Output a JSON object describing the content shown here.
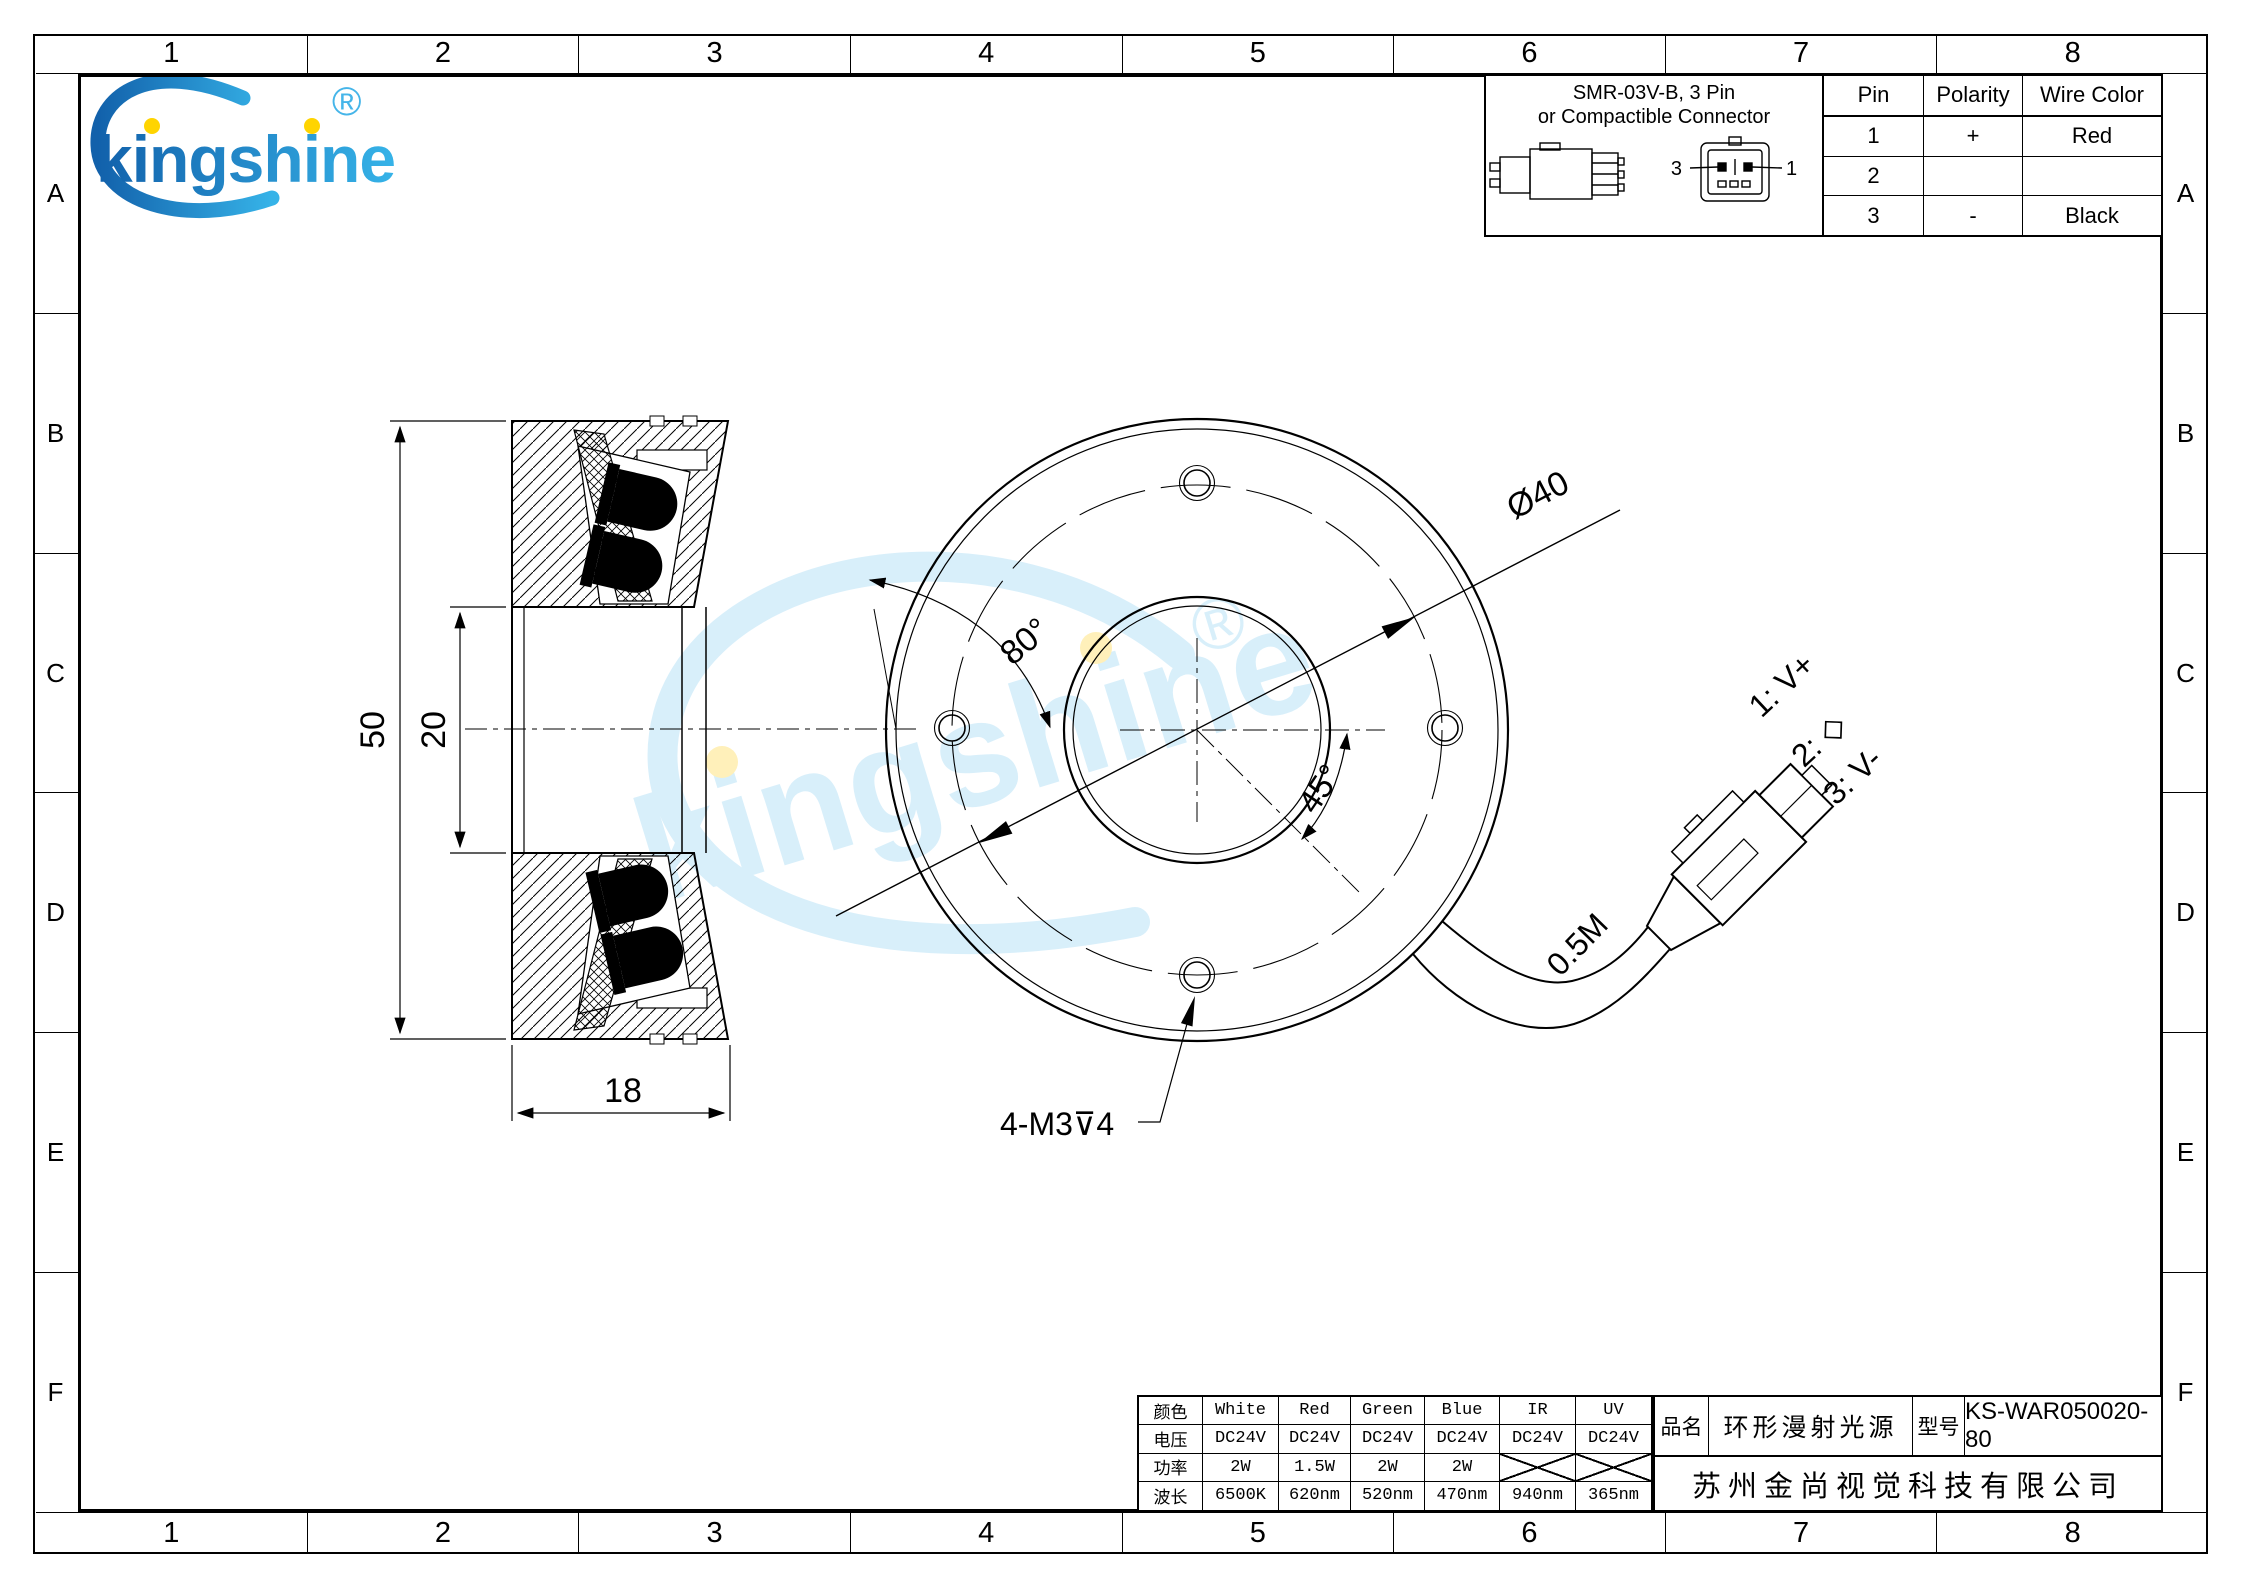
{
  "grid": {
    "columns": [
      "1",
      "2",
      "3",
      "4",
      "5",
      "6",
      "7",
      "8"
    ],
    "rows": [
      "A",
      "B",
      "C",
      "D",
      "E",
      "F"
    ]
  },
  "logo": {
    "brand": "kingshine",
    "registered": "®"
  },
  "watermark": {
    "text": "kingshine",
    "registered": "®"
  },
  "connector_box": {
    "title_line1": "SMR-03V-B, 3 Pin",
    "title_line2": "or Compactible Connector",
    "front_left_pin": "3",
    "front_right_pin": "1"
  },
  "pin_table": {
    "headers": [
      "Pin",
      "Polarity",
      "Wire Color"
    ],
    "rows": [
      [
        "1",
        "+",
        "Red"
      ],
      [
        "2",
        "",
        ""
      ],
      [
        "3",
        "-",
        "Black"
      ]
    ]
  },
  "dims": {
    "height": "50",
    "bore": "20",
    "width": "18",
    "led_angle": "80°",
    "bolt_circle": "Ø40",
    "hole_angle": "45°",
    "thread_note": "4-M3⊽4"
  },
  "cable": {
    "length": "0.5M",
    "pin1": "1: V+",
    "pin2": "2: ◇",
    "pin3": "3: V-"
  },
  "spec_table": {
    "rows": [
      {
        "label": "颜色",
        "values": [
          "White",
          "Red",
          "Green",
          "Blue",
          "IR",
          "UV"
        ]
      },
      {
        "label": "电压",
        "values": [
          "DC24V",
          "DC24V",
          "DC24V",
          "DC24V",
          "DC24V",
          "DC24V"
        ]
      },
      {
        "label": "功率",
        "values": [
          "2W",
          "1.5W",
          "2W",
          "2W",
          "",
          ""
        ]
      },
      {
        "label": "波长",
        "values": [
          "6500K",
          "620nm",
          "520nm",
          "470nm",
          "940nm",
          "365nm"
        ]
      }
    ]
  },
  "title_block": {
    "name_label": "品名",
    "product_name": "环形漫射光源",
    "model_label": "型号",
    "model": "KS-WAR050020-80",
    "company": "苏州金尚视觉科技有限公司"
  },
  "colors": {
    "logo_blue_dark": "#1261ab",
    "logo_blue_light": "#36b3e8",
    "watermark_blue": "#b9e2f7",
    "dot_yellow": "#ffd400",
    "line_black": "#000000"
  }
}
